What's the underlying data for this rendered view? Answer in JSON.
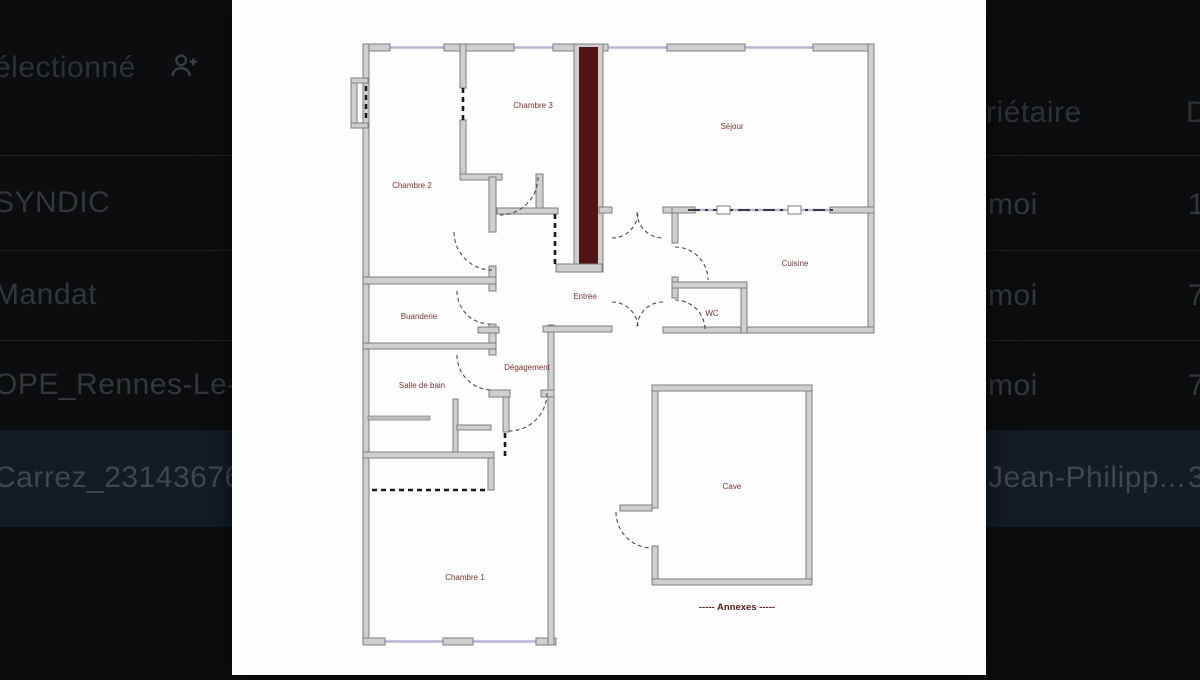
{
  "toolbar": {
    "selection_text": "électionné"
  },
  "table": {
    "header": {
      "owner_col_partial": "riétaire",
      "date_col_partial": "D"
    },
    "rows": [
      {
        "name": "SYNDIC",
        "owner": "moi",
        "date": "1",
        "selected": false
      },
      {
        "name": "Mandat",
        "owner": "moi",
        "date": "7",
        "selected": false
      },
      {
        "name": "OPE_Rennes-Le-Ba",
        "owner": "moi",
        "date": "7",
        "selected": false
      },
      {
        "name": "Carrez_23143676.pd",
        "owner": "Jean-Philipp...",
        "date": "3",
        "selected": true
      }
    ]
  },
  "plan": {
    "rooms": [
      {
        "name": "Chambre 3"
      },
      {
        "name": "Chambre 2"
      },
      {
        "name": "Séjour"
      },
      {
        "name": "Cuisine"
      },
      {
        "name": "Entrée"
      },
      {
        "name": "WC"
      },
      {
        "name": "Buanderie"
      },
      {
        "name": "Dégagement"
      },
      {
        "name": "Salle de bain"
      },
      {
        "name": "Cave"
      },
      {
        "name": "Chambre 1"
      }
    ],
    "annexes_label": "-----  Annexes  -----",
    "colors": {
      "label": "#7b3535",
      "annexes": "#5c1d1d",
      "chimney": "#4f1414",
      "window": "#b3b7d1",
      "wall_fill": "#cfcfcf",
      "wall_stroke": "#7d7d7d",
      "selected_row_bg": "#131b24"
    }
  }
}
